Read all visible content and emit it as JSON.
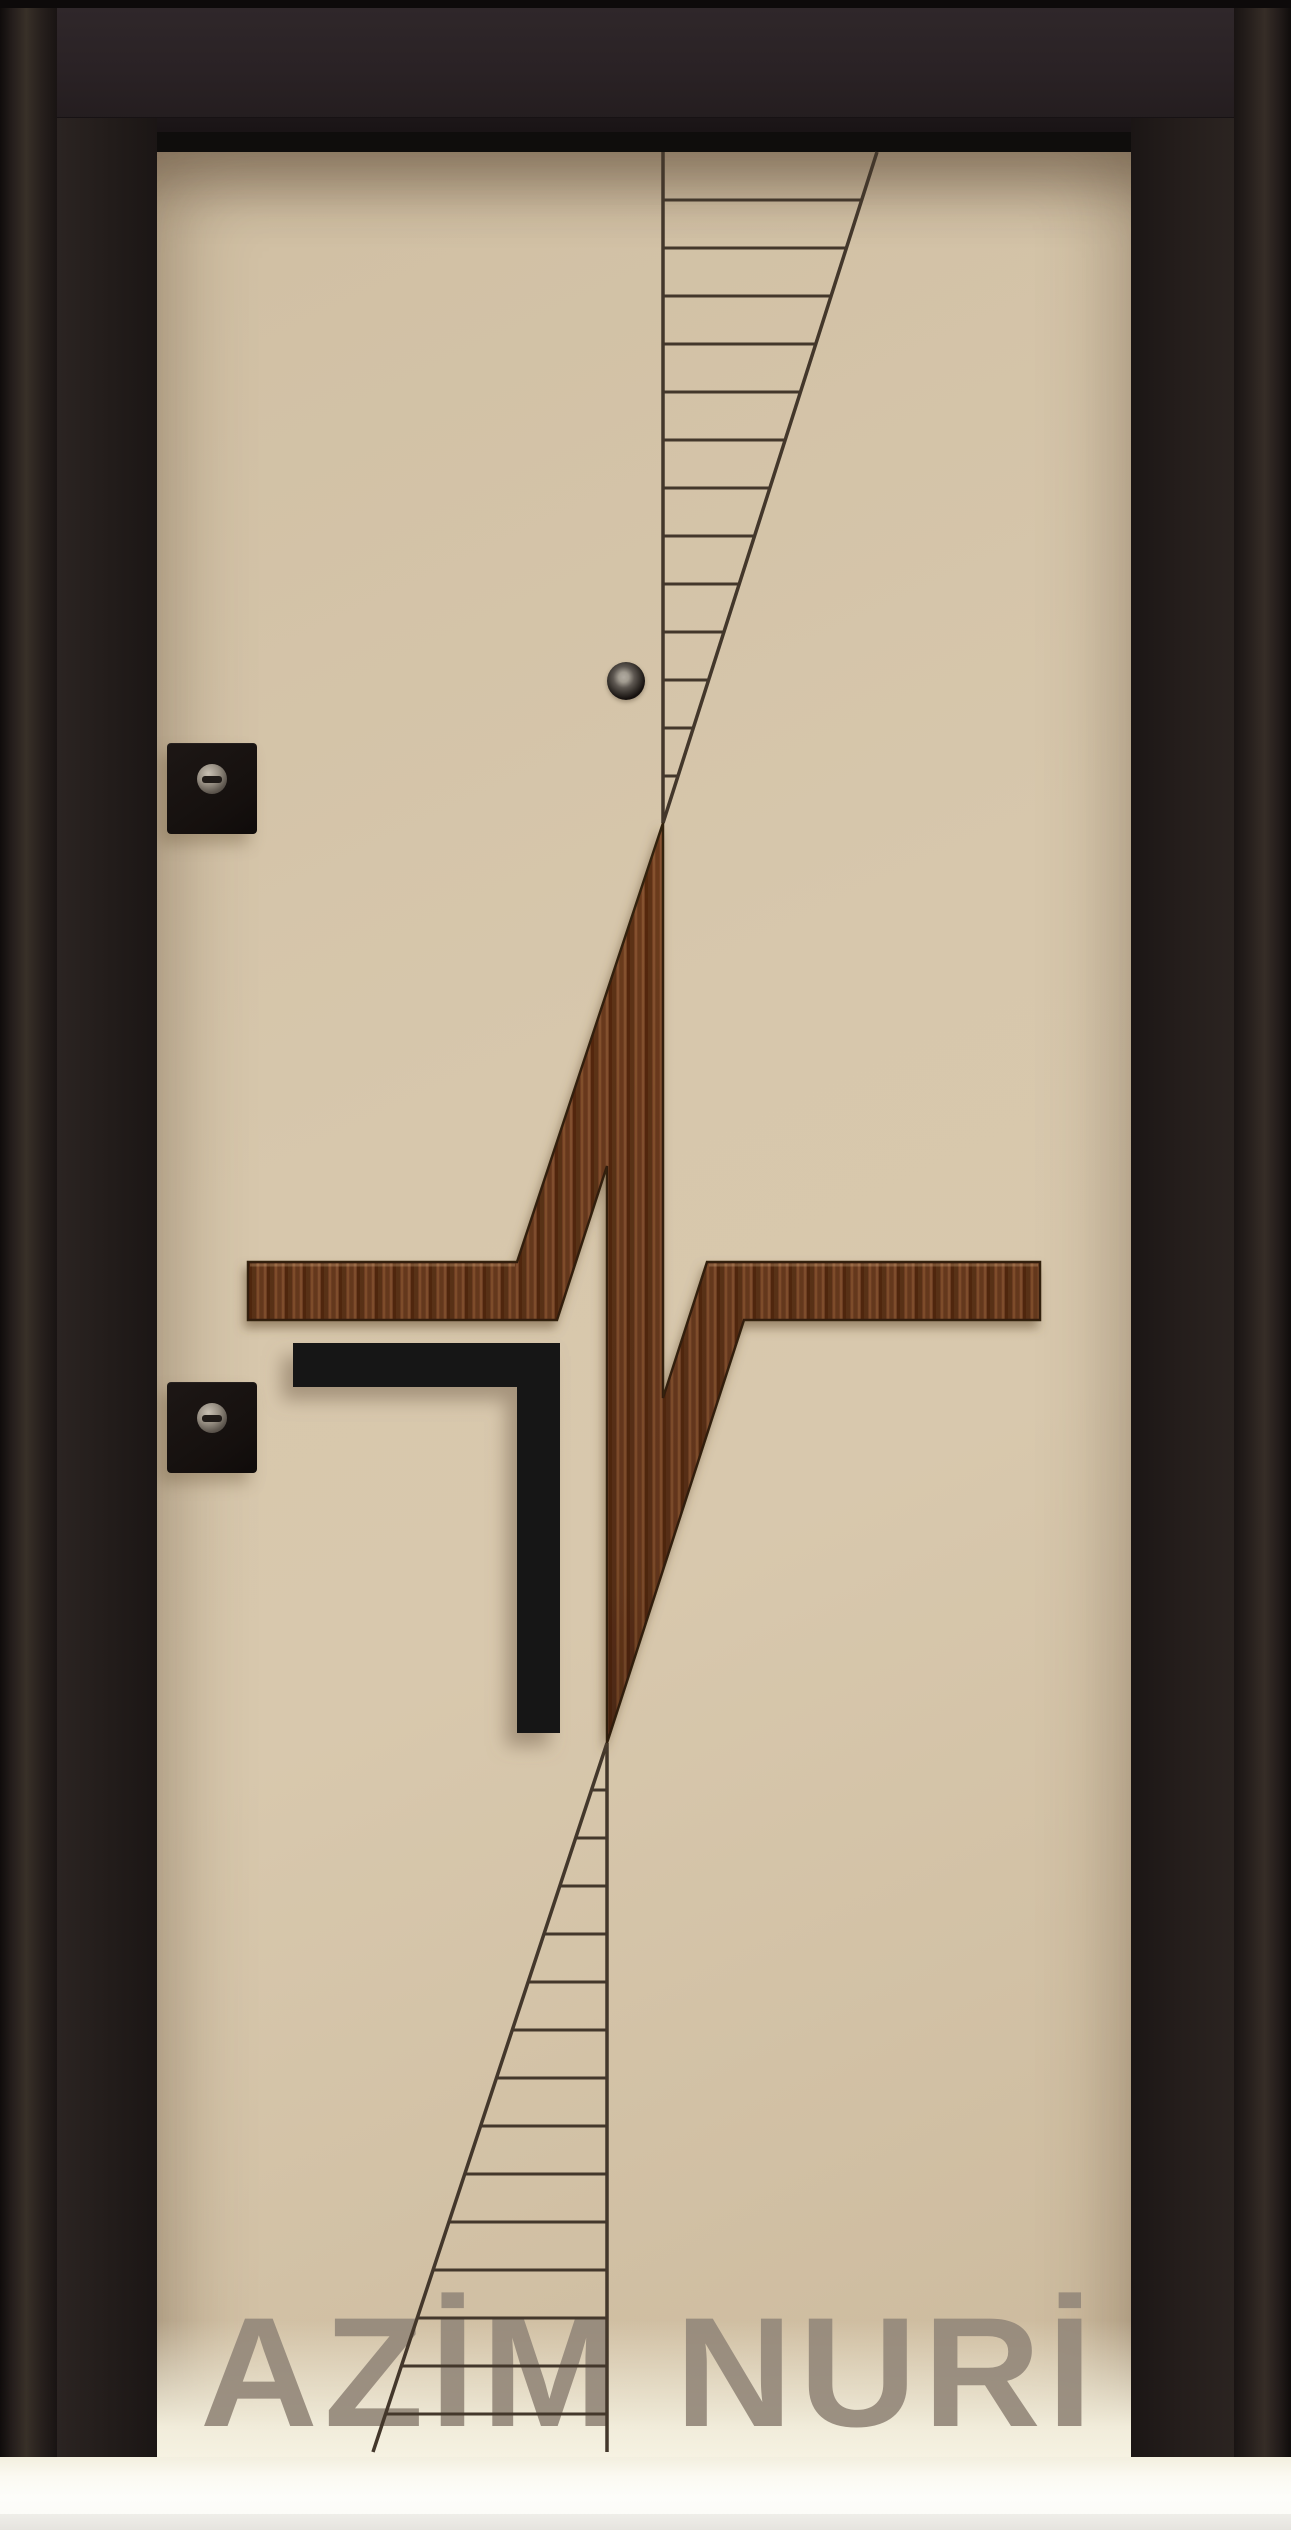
{
  "watermark": {
    "brand": "AZİM NURİ"
  },
  "palette": {
    "frame_dark": "#221b19",
    "panel_beige": "#d6c5aa",
    "wood_base": "#744123",
    "wood_dark": "#55290f",
    "wood_light": "#8f5c36",
    "accent_black": "#181617",
    "engraved_line": "#43372b",
    "watermark_color": "#95897b",
    "threshold_white": "#fdfdfa"
  },
  "design": {
    "pulse_polygon_points": "248,1262 517,1262 663,823 663,1398 707,1262 1040,1262 1040,1320 744,1320 607,1743 607,1166 557,1320 248,1320",
    "handle_path": "M293,1343 H560 V1733 H517 V1387 H293 Z",
    "bar_highlight_path": "M250,1265 H515 M709,1265 H1038",
    "top_ladder": {
      "x": 663,
      "y0": 152,
      "y1": 823,
      "diag_x0": 877,
      "dy0": 152,
      "diag_x1": 663,
      "dy1": 823,
      "rung_start": 200,
      "rung_step": 48,
      "rung_count": 13
    },
    "bottom_ladder": {
      "x": 607,
      "y0": 1743,
      "y1": 2452,
      "diag_x0": 607,
      "dy0": 1743,
      "diag_x1": 373,
      "dy1": 2452,
      "rung_start": 1790,
      "rung_step": 48,
      "rung_count": 14
    }
  },
  "hardware": {
    "peephole": "peephole viewer",
    "upper_lock": "upper deadbolt lock",
    "lower_lock": "lower deadbolt lock",
    "handle_bar": "black corner handle inlay"
  }
}
